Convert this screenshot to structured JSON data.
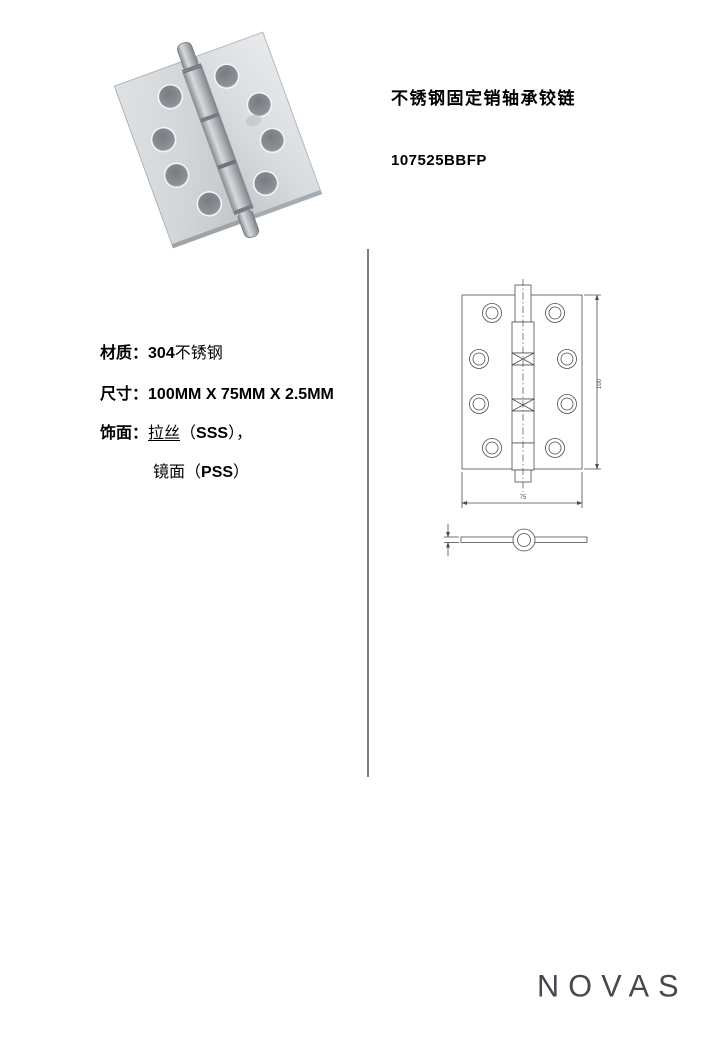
{
  "header": {
    "title": "不锈钢固定销轴承铰链",
    "product_code": "107525BBFP"
  },
  "specs": {
    "material": {
      "label": "材质：",
      "value_bold": "304",
      "value_rest": "不锈钢"
    },
    "size": {
      "label": "尺寸：",
      "value": "100MM X 75MM X 2.5MM"
    },
    "finish": {
      "label": "饰面：",
      "line1": {
        "name": "拉丝",
        "open": "（",
        "code": "SSS",
        "close": "），"
      },
      "line2": {
        "name": "镜面",
        "open": "（",
        "code": "PSS",
        "close": "）"
      }
    }
  },
  "drawing": {
    "height_dim_label": "100",
    "width_dim_label": "75"
  },
  "footer": {
    "brand": "NOVAS"
  },
  "icons": {
    "product_photo": "hinge-photo",
    "front_view": "hinge-front-view-drawing",
    "side_view": "hinge-side-view-drawing"
  },
  "colors": {
    "divider": "#7f7f7f",
    "drawing_line": "#4d4d4d",
    "logo": "#47474d",
    "text": "#000000",
    "metal_light": "#e3e6e8",
    "metal_mid": "#c3c7ca",
    "metal_dark": "#83898e"
  }
}
